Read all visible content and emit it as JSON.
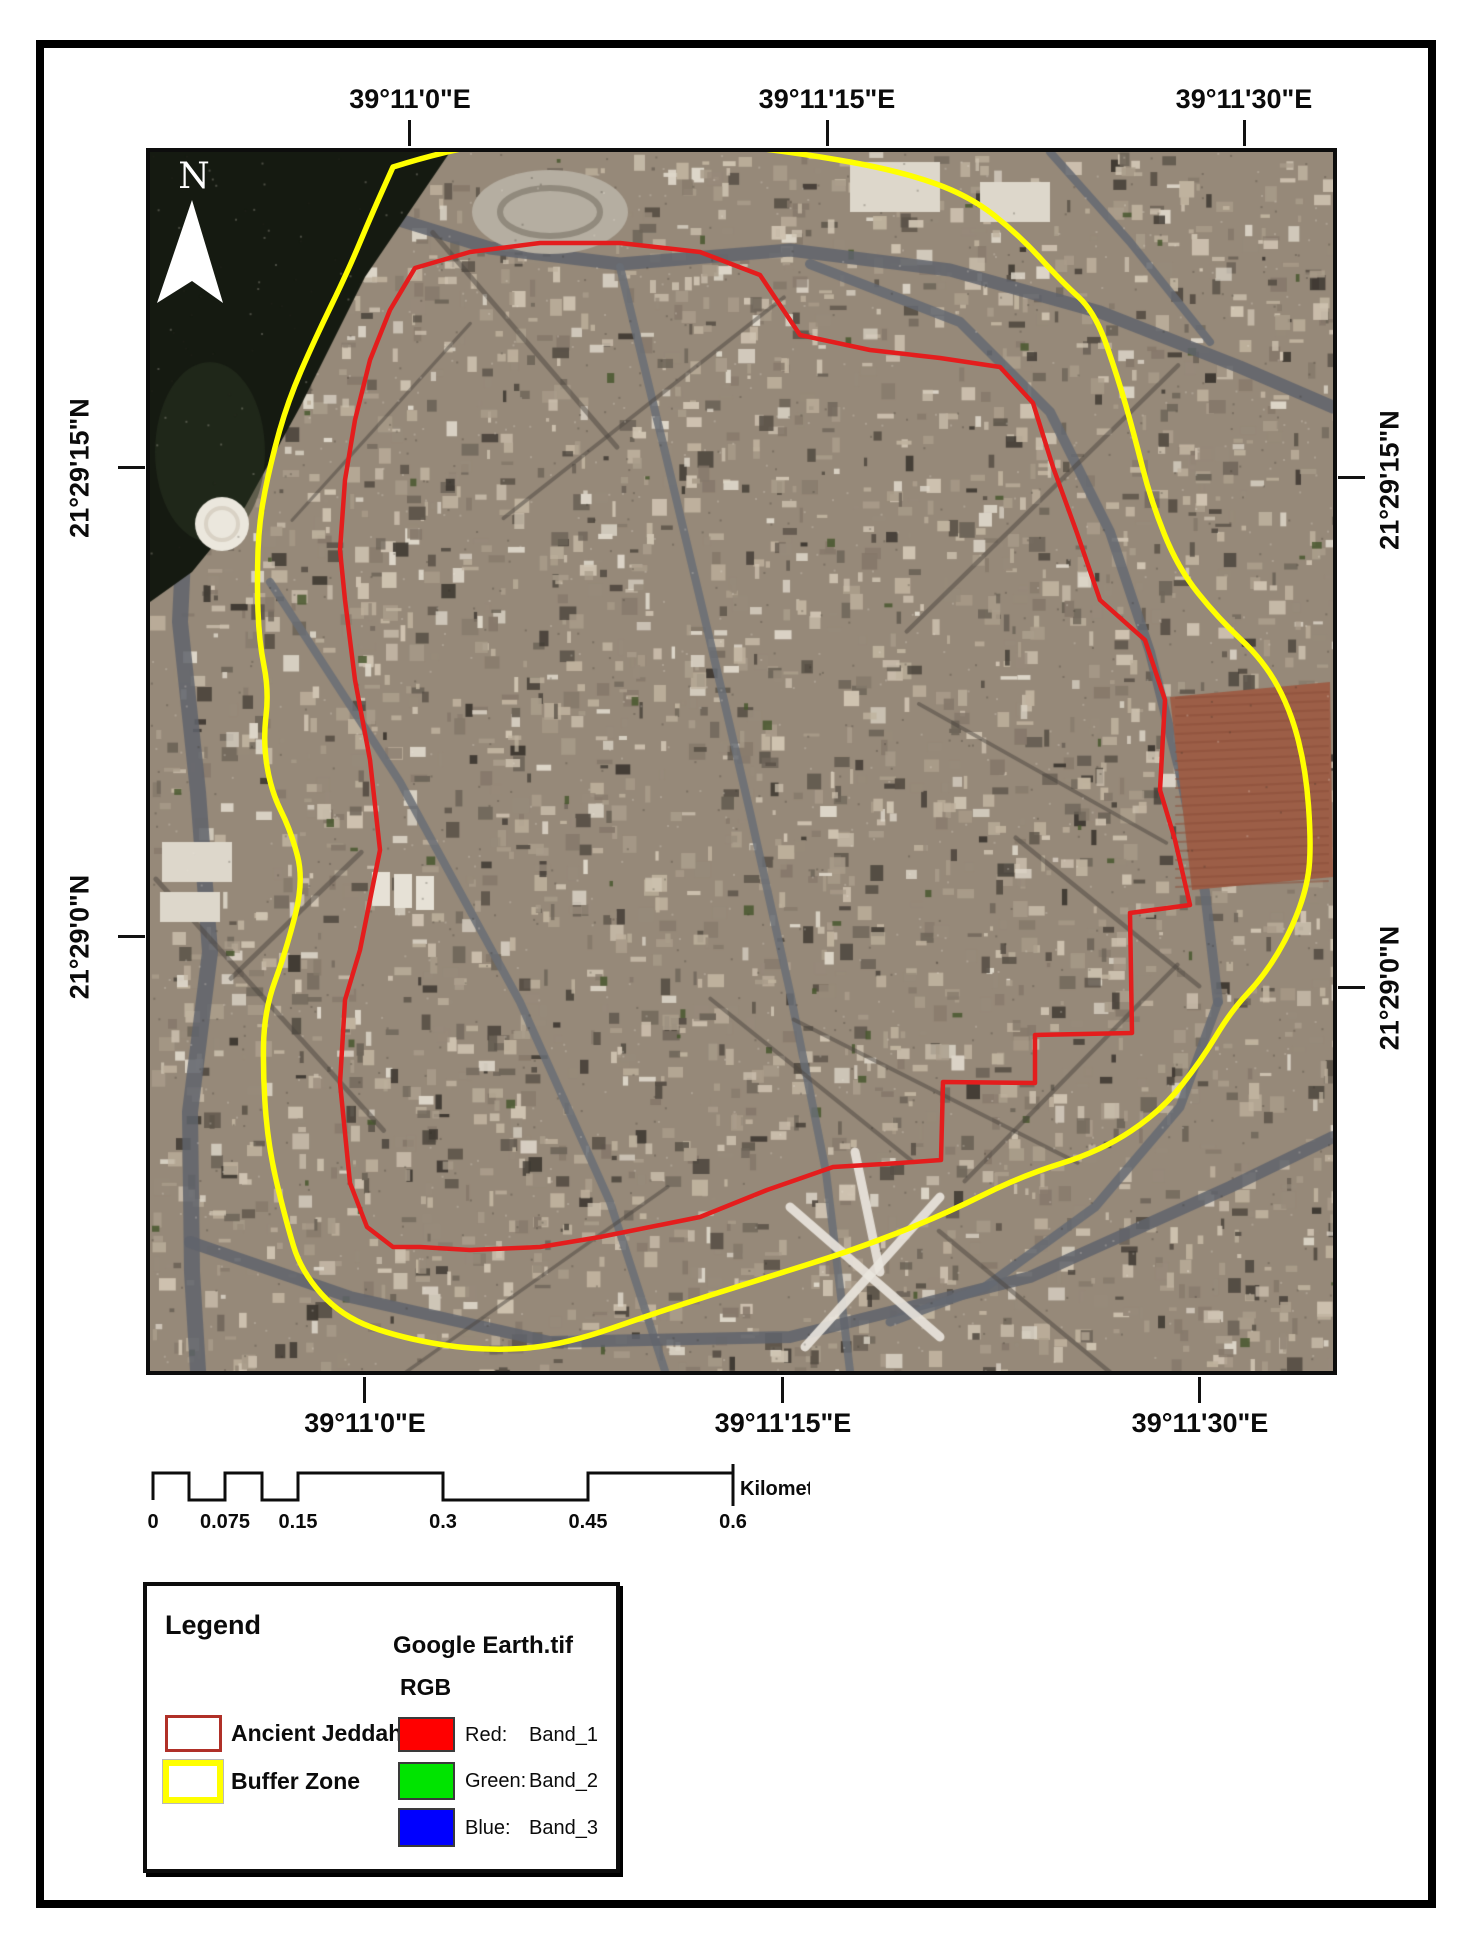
{
  "map": {
    "top_labels": [
      "39°11'0\"E",
      "39°11'15\"E",
      "39°11'30\"E"
    ],
    "bottom_labels": [
      "39°11'0\"E",
      "39°11'15\"E",
      "39°11'30\"E"
    ],
    "left_labels": [
      "21°29'15\"N",
      "21°29'0\"N"
    ],
    "right_labels": [
      "21°29'15\"N",
      "21°29'0\"N"
    ],
    "north_label": "N"
  },
  "scalebar": {
    "labels": [
      "0",
      "0.075",
      "0.15",
      "0.3",
      "0.45",
      "0.6"
    ],
    "unit": "Kilometers"
  },
  "legend": {
    "title": "Legend",
    "raster_title": "Google Earth.tif",
    "raster_mode": "RGB",
    "items": [
      {
        "label": "Ancient Jeddah"
      },
      {
        "label": "Buffer Zone"
      }
    ],
    "bands": [
      {
        "channel": "Red:",
        "band": "Band_1"
      },
      {
        "channel": "Green:",
        "band": "Band_2"
      },
      {
        "channel": "Blue:",
        "band": "Band_3"
      }
    ]
  },
  "colors": {
    "ancient_jeddah_line": "#e41d1d",
    "buffer_zone_line": "#ffff00",
    "legend_ancient_outline": "#b03028",
    "legend_buffer_outline": "#ffff00",
    "band_red": "#ff0000",
    "band_green": "#00e400",
    "band_blue": "#0000ff"
  }
}
